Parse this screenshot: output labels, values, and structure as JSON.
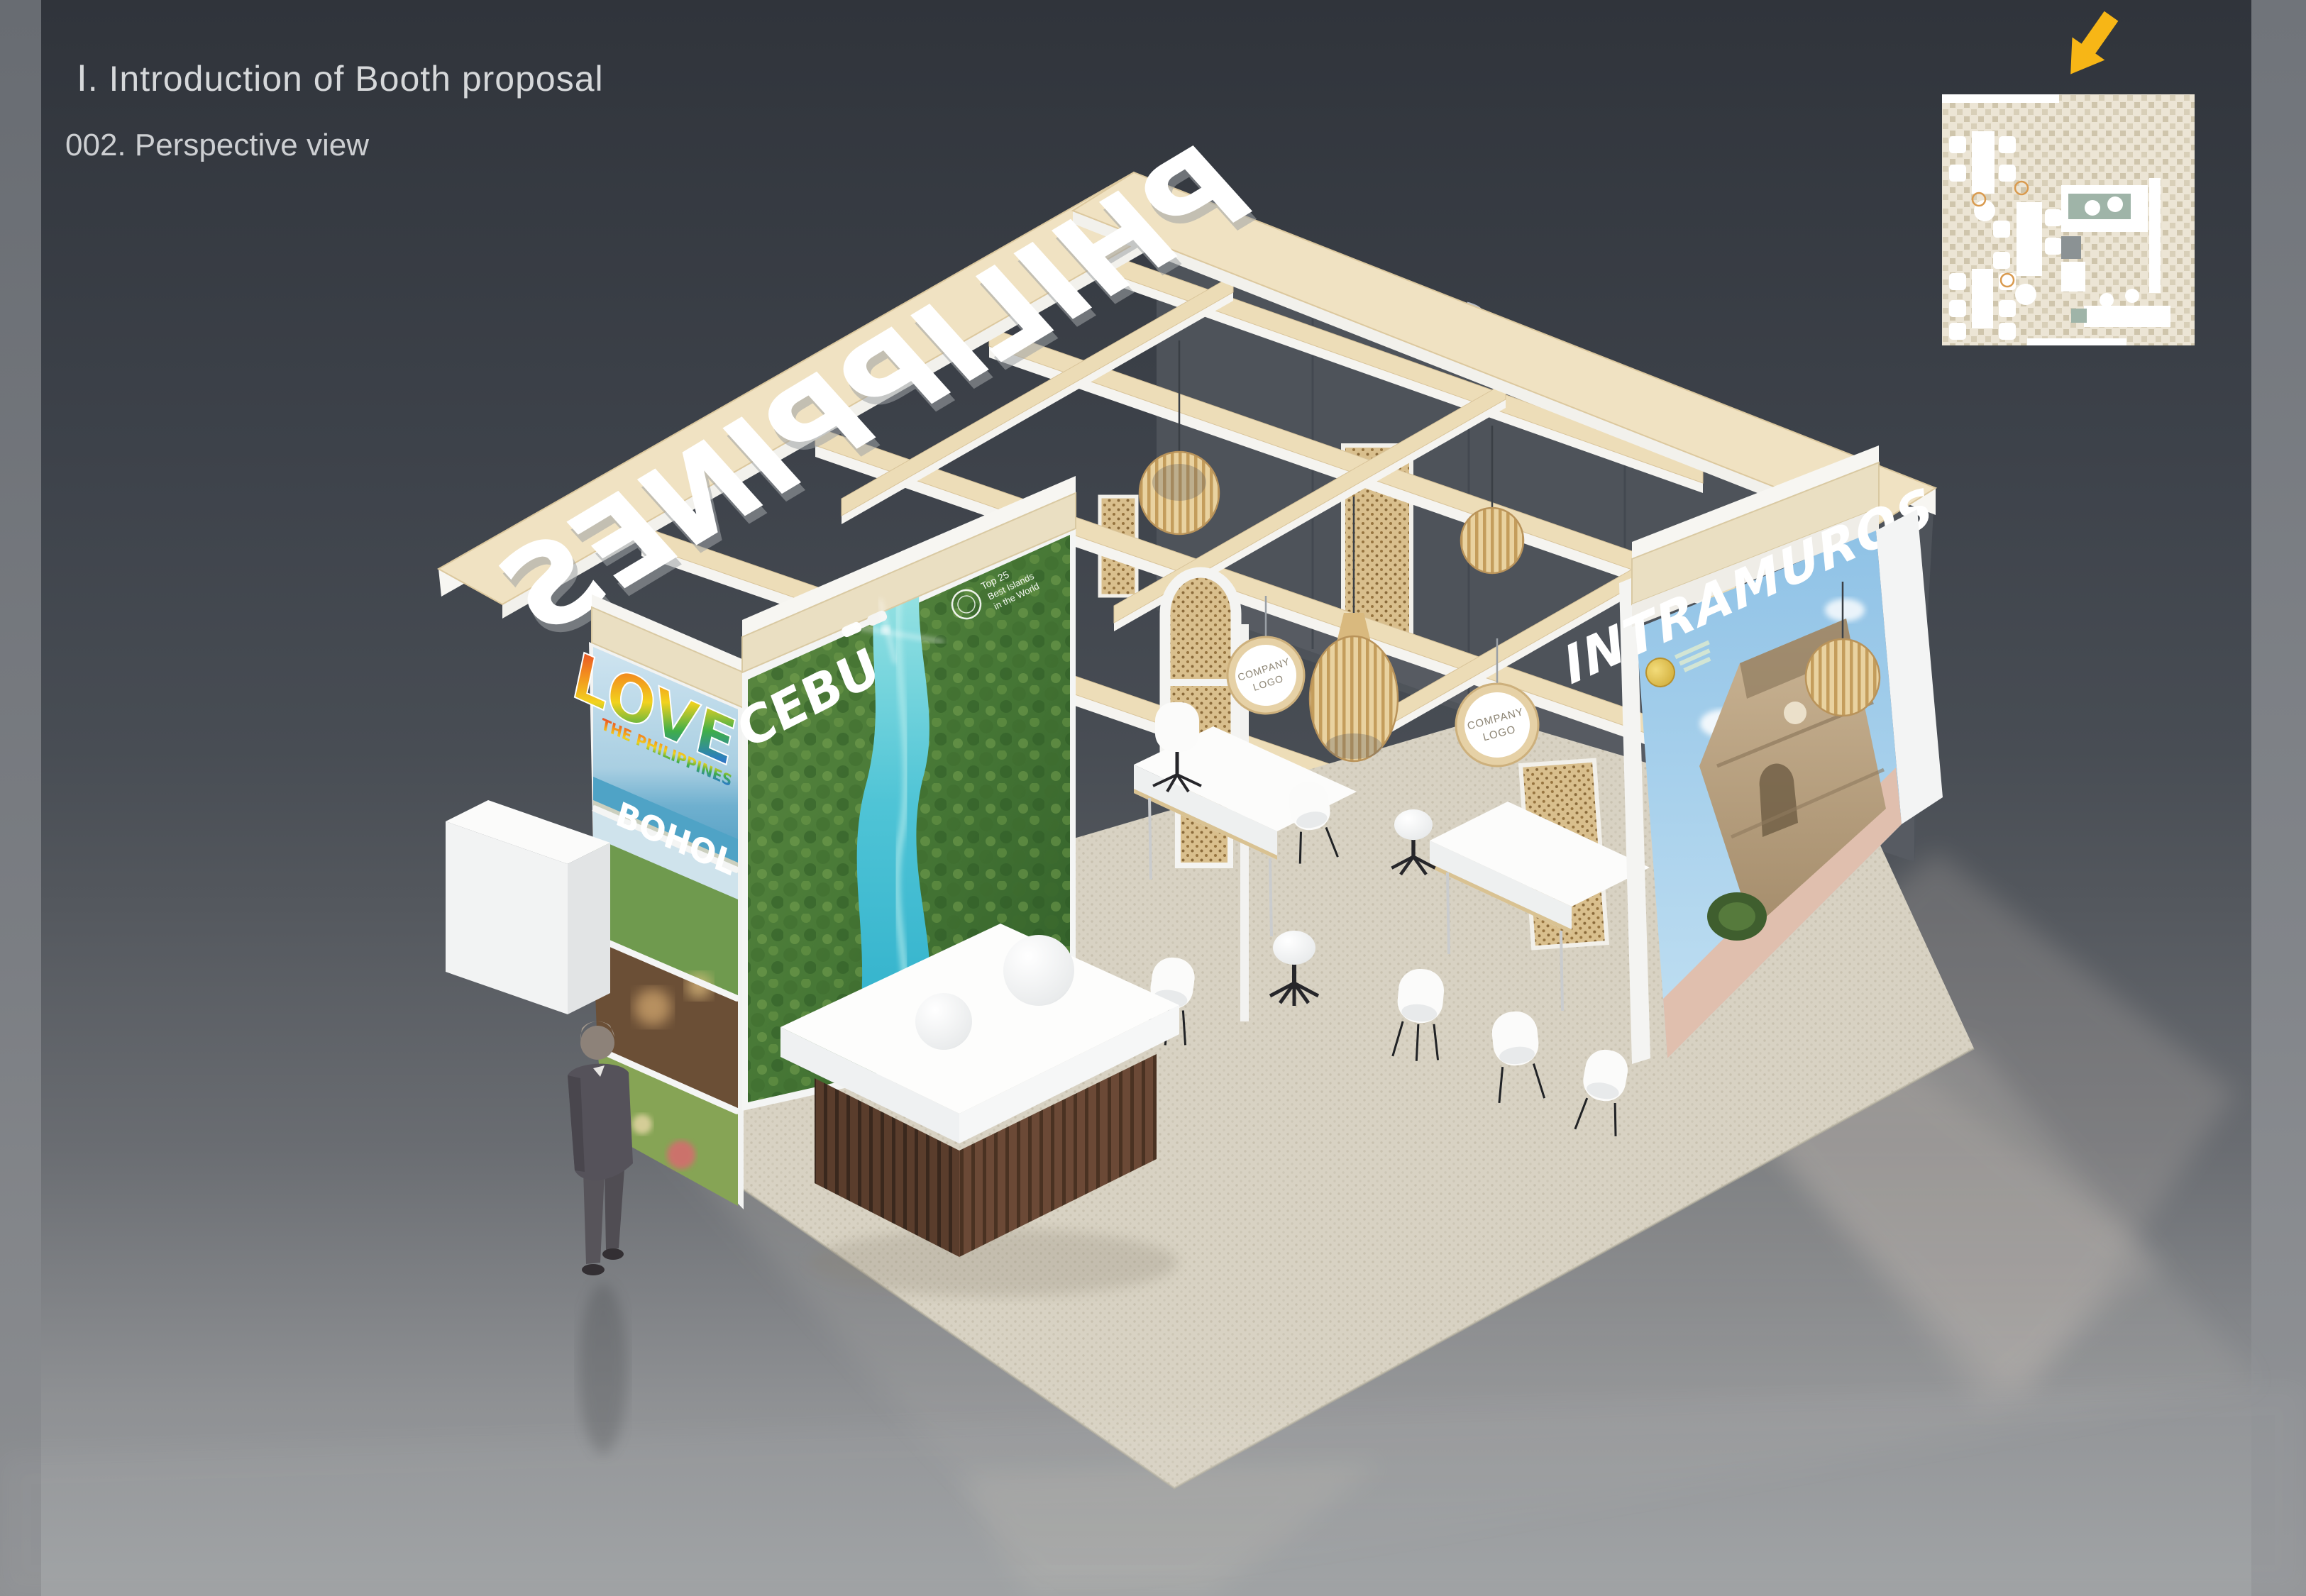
{
  "slide": {
    "title": "Ⅰ. Introduction of Booth proposal",
    "subtitle": "002. Perspective view"
  },
  "inset": {
    "arrow_color": "#F7B616"
  },
  "booth": {
    "roof_sign_text": "PHILIPPINES",
    "back_sign_text": "PHILIPPINES",
    "panels": {
      "love": {
        "word": "LOVE",
        "subline": "THE PHILIPPINES"
      },
      "bohol": {
        "title": "BOHOL"
      },
      "cebu": {
        "title": "CEBU",
        "badge_line1": "Top 25",
        "badge_line2": "Best Islands",
        "badge_line3": "in the World"
      },
      "intramuros": {
        "title": "INTRAMUROS"
      }
    },
    "company_disc": {
      "line1": "COMPANY",
      "line2": "LOGO"
    },
    "colors": {
      "wood": "#EFE0BD",
      "carpet": "#DDD8C9",
      "dark_wall": "#4E535A",
      "desk_wood": "#5A3D2C",
      "river": "#3FC0D4",
      "accent_yellow": "#F7B616"
    }
  }
}
